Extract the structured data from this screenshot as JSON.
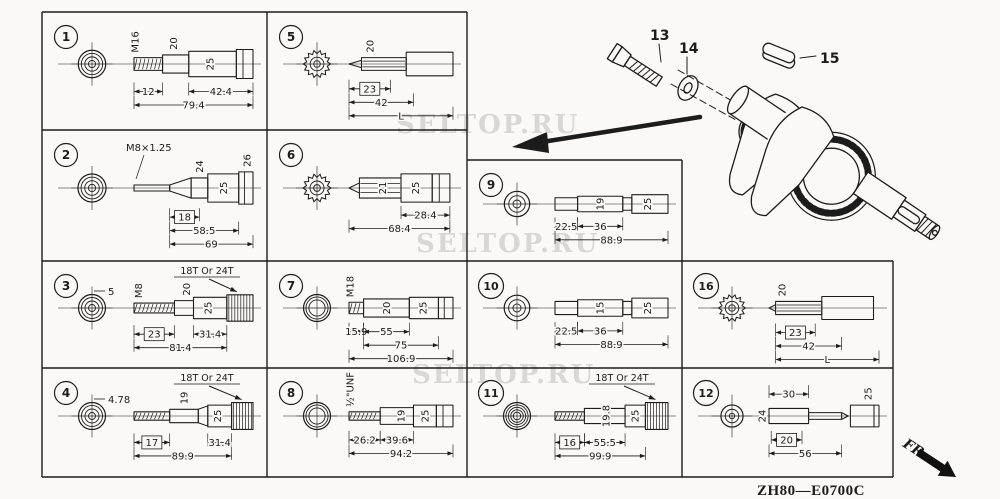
{
  "page": {
    "background": "#faf9f7",
    "ink": "#1c1c1c",
    "watermark_color": "#d0cfcc"
  },
  "watermarks": [
    {
      "text": "SELTOP.RU",
      "x": 396,
      "y": 110
    },
    {
      "text": "SELTOP.RU",
      "x": 416,
      "y": 229
    },
    {
      "text": "SELTOP.RU",
      "x": 412,
      "y": 360
    }
  ],
  "footer": {
    "diagram_code": "ZH80—E0700C",
    "front_label": "FR."
  },
  "hardware_items": [
    {
      "num": "13",
      "name": "flange-bolt"
    },
    {
      "num": "14",
      "name": "plain-washer"
    },
    {
      "num": "15",
      "name": "woodruff-key"
    }
  ],
  "cells": [
    {
      "num": "1",
      "end": "threads",
      "segs": [
        [
          0,
          0.24,
          7,
          "thread"
        ],
        [
          0.24,
          0.46,
          10
        ],
        [
          0.46,
          0.86,
          14
        ],
        [
          0.86,
          1,
          16,
          "flange"
        ]
      ],
      "labels": [
        {
          "t": "M16",
          "k": "rot",
          "f": 0.01
        },
        {
          "t": "20",
          "k": "rot",
          "f": 0.33
        },
        {
          "t": "25",
          "k": "in",
          "f": 0.64
        }
      ],
      "rows": [
        [
          {
            "t": "12",
            "a": 0,
            "b": 0.24
          },
          {
            "t": "42.4",
            "a": 0.46,
            "b": 1
          }
        ],
        [
          {
            "t": "79.4",
            "a": 0,
            "b": 1
          }
        ]
      ]
    },
    {
      "num": "5",
      "end": "spline",
      "segs": [
        [
          0,
          0.12,
          4,
          "tipl"
        ],
        [
          0.12,
          0.55,
          7,
          "spline"
        ],
        [
          0.55,
          1,
          13
        ]
      ],
      "labels": [
        {
          "t": "20",
          "k": "rot",
          "f": 0.2
        }
      ],
      "rows": [
        [
          {
            "t": "23",
            "a": 0,
            "b": 0.4,
            "box": true
          }
        ],
        [
          {
            "t": "42",
            "a": 0,
            "b": 0.62
          }
        ],
        [
          {
            "t": "L",
            "a": 0,
            "b": 1
          }
        ]
      ]
    },
    {
      "num": "2",
      "end": "threads",
      "segs": [
        [
          0,
          0.3,
          3
        ],
        [
          0.3,
          0.48,
          10,
          "taper"
        ],
        [
          0.48,
          0.62,
          10
        ],
        [
          0.62,
          0.88,
          14
        ],
        [
          0.88,
          1,
          16,
          "flange"
        ]
      ],
      "labels": [
        {
          "t": "M8×1.25",
          "k": "h",
          "f": 0
        },
        {
          "t": "24",
          "k": "rot",
          "f": 0.55
        },
        {
          "t": "25",
          "k": "in",
          "f": 0.75
        },
        {
          "t": "26",
          "k": "rot",
          "f": 0.95
        }
      ],
      "rows": [
        [
          {
            "t": "18",
            "a": 0.3,
            "b": 0.55,
            "box": true
          }
        ],
        [
          {
            "t": "58.5",
            "a": 0.3,
            "b": 0.88
          }
        ],
        [
          {
            "t": "69",
            "a": 0.3,
            "b": 1
          }
        ]
      ]
    },
    {
      "num": "6",
      "end": "spline",
      "segs": [
        [
          0,
          0.1,
          5,
          "tipl"
        ],
        [
          0.1,
          0.5,
          10,
          "spline"
        ],
        [
          0.5,
          0.8,
          14
        ],
        [
          0.8,
          0.97,
          14,
          "flange"
        ]
      ],
      "labels": [
        {
          "t": "21",
          "k": "in",
          "f": 0.32
        },
        {
          "t": "25",
          "k": "in",
          "f": 0.64
        }
      ],
      "rows": [
        [
          {
            "t": "28.4",
            "a": 0.5,
            "b": 0.97
          }
        ],
        [
          {
            "t": "68.4",
            "a": 0,
            "b": 0.97
          }
        ]
      ]
    },
    {
      "num": "9",
      "end": "plain",
      "segs": [
        [
          0,
          0.2,
          8
        ],
        [
          0.2,
          0.6,
          10
        ],
        [
          0.6,
          0.68,
          8
        ],
        [
          0.68,
          1,
          12
        ]
      ],
      "labels": [
        {
          "t": "19",
          "k": "in",
          "f": 0.4
        },
        {
          "t": "25",
          "k": "in",
          "f": 0.82
        }
      ],
      "rows": [
        [
          {
            "t": "22.5",
            "a": 0,
            "b": 0.2
          },
          {
            "t": "36",
            "a": 0.2,
            "b": 0.6
          }
        ],
        [
          {
            "t": "88.9",
            "a": 0,
            "b": 1
          }
        ]
      ]
    },
    {
      "num": "3",
      "end": "threads",
      "segs": [
        [
          0,
          0.34,
          6,
          "thread"
        ],
        [
          0.34,
          0.5,
          9
        ],
        [
          0.5,
          0.78,
          13
        ],
        [
          0.78,
          1,
          16,
          "gear"
        ]
      ],
      "labels": [
        {
          "t": "M8",
          "k": "rot",
          "f": 0.04
        },
        {
          "t": "20",
          "k": "rot",
          "f": 0.44
        },
        {
          "t": "25",
          "k": "in",
          "f": 0.62
        }
      ],
      "front": "5",
      "note": "18T Or 24T",
      "rows": [
        [
          {
            "t": "23",
            "a": 0,
            "b": 0.34,
            "box": true
          },
          {
            "t": "31.4",
            "a": 0.5,
            "b": 0.78
          }
        ],
        [
          {
            "t": "81.4",
            "a": 0,
            "b": 0.78
          }
        ]
      ]
    },
    {
      "num": "7",
      "end": "ring",
      "segs": [
        [
          0,
          0.14,
          7,
          "thread"
        ],
        [
          0.14,
          0.58,
          11
        ],
        [
          0.58,
          0.86,
          13
        ],
        [
          0.86,
          1,
          13,
          "flange"
        ]
      ],
      "labels": [
        {
          "t": "M18",
          "k": "rot",
          "f": 0.01
        },
        {
          "t": "20",
          "k": "in",
          "f": 0.36
        },
        {
          "t": "25",
          "k": "in",
          "f": 0.71
        }
      ],
      "rows": [
        [
          {
            "t": "15.9",
            "a": 0,
            "b": 0.14
          },
          {
            "t": "55",
            "a": 0.14,
            "b": 0.58
          }
        ],
        [
          {
            "t": "75",
            "a": 0.14,
            "b": 0.86
          }
        ],
        [
          {
            "t": "106.9",
            "a": 0,
            "b": 1
          }
        ]
      ]
    },
    {
      "num": "10",
      "end": "plain",
      "segs": [
        [
          0,
          0.2,
          8
        ],
        [
          0.2,
          0.6,
          10
        ],
        [
          0.6,
          0.68,
          8
        ],
        [
          0.68,
          1,
          12
        ]
      ],
      "labels": [
        {
          "t": "15",
          "k": "in",
          "f": 0.4
        },
        {
          "t": "25",
          "k": "in",
          "f": 0.82
        }
      ],
      "rows": [
        [
          {
            "t": "22.5",
            "a": 0,
            "b": 0.2
          },
          {
            "t": "36",
            "a": 0.2,
            "b": 0.6
          }
        ],
        [
          {
            "t": "88.9",
            "a": 0,
            "b": 1
          }
        ]
      ]
    },
    {
      "num": "16",
      "end": "spline",
      "segs": [
        [
          0,
          0.06,
          4,
          "tipl"
        ],
        [
          0.06,
          0.48,
          8,
          "spline"
        ],
        [
          0.48,
          0.95,
          14
        ]
      ],
      "labels": [
        {
          "t": "20",
          "k": "rot",
          "f": 0.12
        }
      ],
      "rows": [
        [
          {
            "t": "23",
            "a": 0.06,
            "b": 0.42,
            "box": true
          }
        ],
        [
          {
            "t": "42",
            "a": 0.06,
            "b": 0.66
          }
        ],
        [
          {
            "t": "L",
            "a": 0.06,
            "b": 1
          }
        ]
      ]
    },
    {
      "num": "4",
      "end": "threads",
      "segs": [
        [
          0,
          0.3,
          5,
          "thread"
        ],
        [
          0.3,
          0.54,
          8
        ],
        [
          0.54,
          0.62,
          12,
          "taper"
        ],
        [
          0.62,
          0.82,
          13
        ],
        [
          0.82,
          1,
          16,
          "gear"
        ]
      ],
      "labels": [
        {
          "t": "19",
          "k": "rot",
          "f": 0.42
        },
        {
          "t": "25",
          "k": "in",
          "f": 0.7
        }
      ],
      "front": "4.78",
      "note": "18T Or 24T",
      "rows": [
        [
          {
            "t": "17",
            "a": 0,
            "b": 0.3,
            "box": true
          },
          {
            "t": "31.4",
            "a": 0.62,
            "b": 0.82
          }
        ],
        [
          {
            "t": "89.9",
            "a": 0,
            "b": 0.82
          }
        ]
      ]
    },
    {
      "num": "8",
      "end": "ring",
      "segs": [
        [
          0,
          0.3,
          5,
          "thread"
        ],
        [
          0.3,
          0.62,
          10
        ],
        [
          0.62,
          0.84,
          13
        ],
        [
          0.84,
          1,
          13,
          "flange"
        ]
      ],
      "labels": [
        {
          "t": "½\"UNF",
          "k": "rot",
          "f": 0.01
        },
        {
          "t": "19",
          "k": "in",
          "f": 0.5
        },
        {
          "t": "25",
          "k": "in",
          "f": 0.73
        }
      ],
      "rows": [
        [
          {
            "t": "26.2",
            "a": 0,
            "b": 0.3
          },
          {
            "t": "39.6",
            "a": 0.3,
            "b": 0.62
          }
        ],
        [
          {
            "t": "94.2",
            "a": 0,
            "b": 1
          }
        ]
      ]
    },
    {
      "num": "11",
      "end": "coil",
      "segs": [
        [
          0,
          0.26,
          5,
          "thread"
        ],
        [
          0.26,
          0.62,
          9
        ],
        [
          0.62,
          0.8,
          13
        ],
        [
          0.8,
          1,
          16,
          "gear"
        ]
      ],
      "labels": [
        {
          "t": "19.8",
          "k": "in",
          "f": 0.45
        },
        {
          "t": "25",
          "k": "in",
          "f": 0.71
        }
      ],
      "note": "18T Or 24T",
      "rows": [
        [
          {
            "t": "16",
            "a": 0,
            "b": 0.26,
            "box": true
          },
          {
            "t": "55.5",
            "a": 0.26,
            "b": 0.62
          }
        ],
        [
          {
            "t": "99.9",
            "a": 0,
            "b": 0.8
          }
        ]
      ]
    },
    {
      "num": "12",
      "end": "plain-sm",
      "segs": [
        [
          0,
          0.36,
          9
        ],
        [
          0.36,
          0.66,
          4
        ],
        [
          0.66,
          0.72,
          4,
          "tipr"
        ],
        [
          0.74,
          1,
          13,
          "open"
        ]
      ],
      "labels": [
        {
          "t": "24",
          "k": "rotl",
          "f": 0
        },
        {
          "t": "25",
          "k": "rot",
          "f": 0.9
        }
      ],
      "top": {
        "t": "30",
        "a": 0,
        "b": 0.36
      },
      "rows": [
        [
          {
            "t": "20",
            "a": 0.02,
            "b": 0.3,
            "box": true
          }
        ],
        [
          {
            "t": "56",
            "a": 0,
            "b": 0.66
          }
        ]
      ]
    }
  ]
}
